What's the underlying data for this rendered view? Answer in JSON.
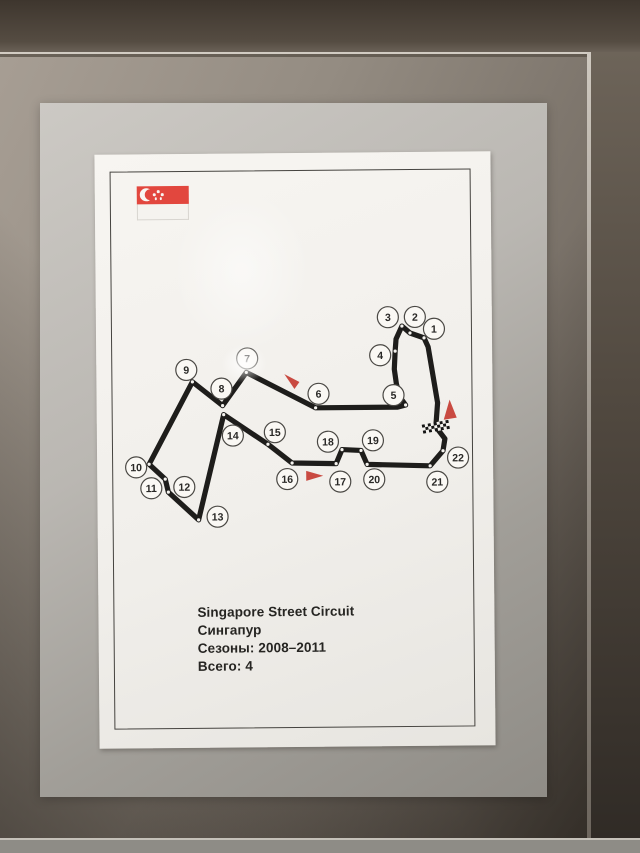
{
  "poster": {
    "caption": {
      "line1": "Singapore Street Circuit",
      "line2": "Сингапур",
      "line3": "Сезоны: 2008–2011",
      "line4": "Всего: 4"
    },
    "flag": {
      "name": "flag-of-singapore",
      "red": "#e2473e",
      "stars": 5
    },
    "circuit": {
      "colors": {
        "track": "#1e1d1b",
        "arrow": "#c94a41",
        "circle_fill": "#faf8f4",
        "circle_stroke": "#4a4844",
        "apex_dot": "#f6f4f0"
      },
      "track_points": [
        [
          339,
          275
        ],
        [
          341,
          251
        ],
        [
          332,
          195
        ],
        [
          328,
          186
        ],
        [
          314,
          181
        ],
        [
          306,
          174
        ],
        [
          300,
          187
        ],
        [
          299,
          199
        ],
        [
          298,
          217
        ],
        [
          300,
          232
        ],
        [
          304,
          246
        ],
        [
          309,
          253
        ],
        [
          301,
          255
        ],
        [
          219,
          255
        ],
        [
          150,
          219
        ],
        [
          126,
          252
        ],
        [
          96,
          228
        ],
        [
          52,
          310
        ],
        [
          68,
          325
        ],
        [
          71,
          338
        ],
        [
          101,
          366
        ],
        [
          127,
          261
        ],
        [
          171,
          291
        ],
        [
          195,
          310
        ],
        [
          239,
          311
        ],
        [
          245,
          297
        ],
        [
          264,
          298
        ],
        [
          270,
          312
        ],
        [
          333,
          314
        ],
        [
          346,
          299
        ],
        [
          348,
          287
        ]
      ],
      "corners": [
        {
          "n": "1",
          "lx": 338,
          "ly": 177,
          "ax": 328,
          "ay": 186
        },
        {
          "n": "2",
          "lx": 319,
          "ly": 165,
          "ax": 314,
          "ay": 181
        },
        {
          "n": "3",
          "lx": 292,
          "ly": 165,
          "ax": 306,
          "ay": 174
        },
        {
          "n": "4",
          "lx": 284,
          "ly": 203,
          "ax": 299,
          "ay": 199
        },
        {
          "n": "5",
          "lx": 297,
          "ly": 243,
          "ax": 309,
          "ay": 253
        },
        {
          "n": "6",
          "lx": 222,
          "ly": 241,
          "ax": 219,
          "ay": 255
        },
        {
          "n": "7",
          "lx": 151,
          "ly": 205,
          "ax": 150,
          "ay": 219
        },
        {
          "n": "8",
          "lx": 125,
          "ly": 235,
          "ax": 126,
          "ay": 252
        },
        {
          "n": "9",
          "lx": 90,
          "ly": 216,
          "ax": 96,
          "ay": 228
        },
        {
          "n": "10",
          "lx": 39,
          "ly": 313,
          "ax": 52,
          "ay": 310
        },
        {
          "n": "11",
          "lx": 54,
          "ly": 334,
          "ax": 68,
          "ay": 325
        },
        {
          "n": "12",
          "lx": 87,
          "ly": 333,
          "ax": 71,
          "ay": 338
        },
        {
          "n": "13",
          "lx": 120,
          "ly": 363,
          "ax": 101,
          "ay": 366
        },
        {
          "n": "14",
          "lx": 136,
          "ly": 282,
          "ax": 127,
          "ay": 261
        },
        {
          "n": "15",
          "lx": 178,
          "ly": 279,
          "ax": 171,
          "ay": 291
        },
        {
          "n": "16",
          "lx": 190,
          "ly": 326,
          "ax": 195,
          "ay": 310
        },
        {
          "n": "17",
          "lx": 243,
          "ly": 329,
          "ax": 239,
          "ay": 311
        },
        {
          "n": "18",
          "lx": 231,
          "ly": 289,
          "ax": 245,
          "ay": 297
        },
        {
          "n": "19",
          "lx": 276,
          "ly": 288,
          "ax": 264,
          "ay": 298
        },
        {
          "n": "20",
          "lx": 277,
          "ly": 327,
          "ax": 270,
          "ay": 312
        },
        {
          "n": "21",
          "lx": 340,
          "ly": 330,
          "ax": 333,
          "ay": 314
        },
        {
          "n": "22",
          "lx": 361,
          "ly": 306,
          "ax": 346,
          "ay": 299
        }
      ],
      "start_finish": {
        "x": 339,
        "y": 275,
        "rotate": -10,
        "rows": 3,
        "cols": 9,
        "cell": 3
      },
      "direction_arrows": [
        {
          "name": "start-finish-direction",
          "points": [
            [
              353,
              248
            ],
            [
              347,
              268
            ],
            [
              360,
              266
            ]
          ]
        },
        {
          "name": "mid-section-direction",
          "points": [
            [
              188,
              221
            ],
            [
              203,
              229
            ],
            [
              198,
              236
            ]
          ]
        },
        {
          "name": "bottom-section-direction",
          "points": [
            [
              226,
              323
            ],
            [
              209,
              318
            ],
            [
              209,
              328
            ]
          ]
        }
      ]
    }
  }
}
